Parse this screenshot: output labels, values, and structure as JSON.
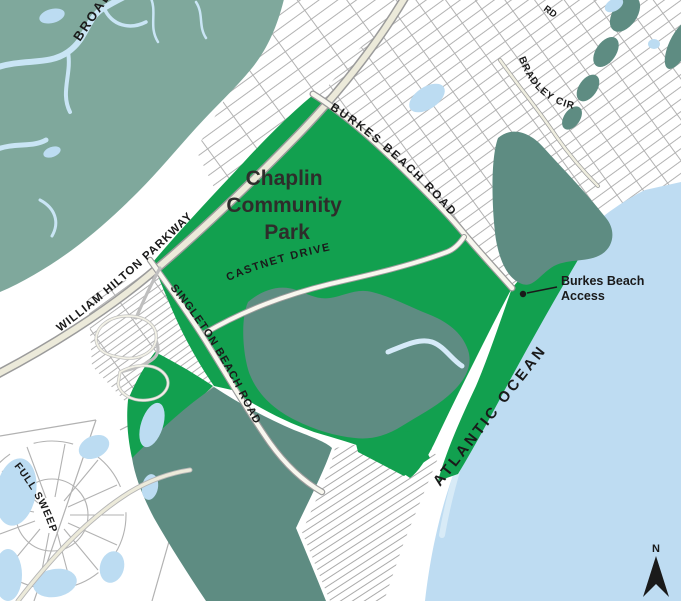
{
  "map": {
    "title": "Chaplin Community Park and Burkes Beach access map",
    "labels": {
      "park_name_line1": "Chaplin",
      "park_name_line2": "Community",
      "park_name_line3": "Park",
      "roads": {
        "william_hilton_parkway": "WILLIAM HILTON PARKWAY",
        "burkes_beach_road": "BURKES BEACH ROAD",
        "castnet_drive": "CASTNET DRIVE",
        "singleton_beach_road": "SINGLETON BEACH ROAD",
        "bradley_cir": "BRADLEY CIR",
        "full_sweep": "FULL SWEEP",
        "partial_road_top": "RD"
      },
      "water": {
        "broad_creek": "BROAD",
        "atlantic_ocean": "ATLANTIC OCEAN"
      },
      "poi": {
        "burkes_beach_access_line1": "Burkes Beach",
        "burkes_beach_access_line2": "Access"
      },
      "compass_north": "N"
    }
  },
  "colors": {
    "park_green": "#12a04f",
    "marsh_light": "#7fa89c",
    "marsh_dark": "#5e8c82",
    "water": "#bcdcf2",
    "ocean": "#bedcf2",
    "creek": "#c9e5f5",
    "land": "#ffffff",
    "parcel_line": "#b2b2b2",
    "road_casing": "#9b9b9b",
    "road_fill": "#eceada",
    "road_fill_light": "#f8f7ef",
    "label": "#1a1a1a",
    "park_label": "#2e2d2b"
  }
}
